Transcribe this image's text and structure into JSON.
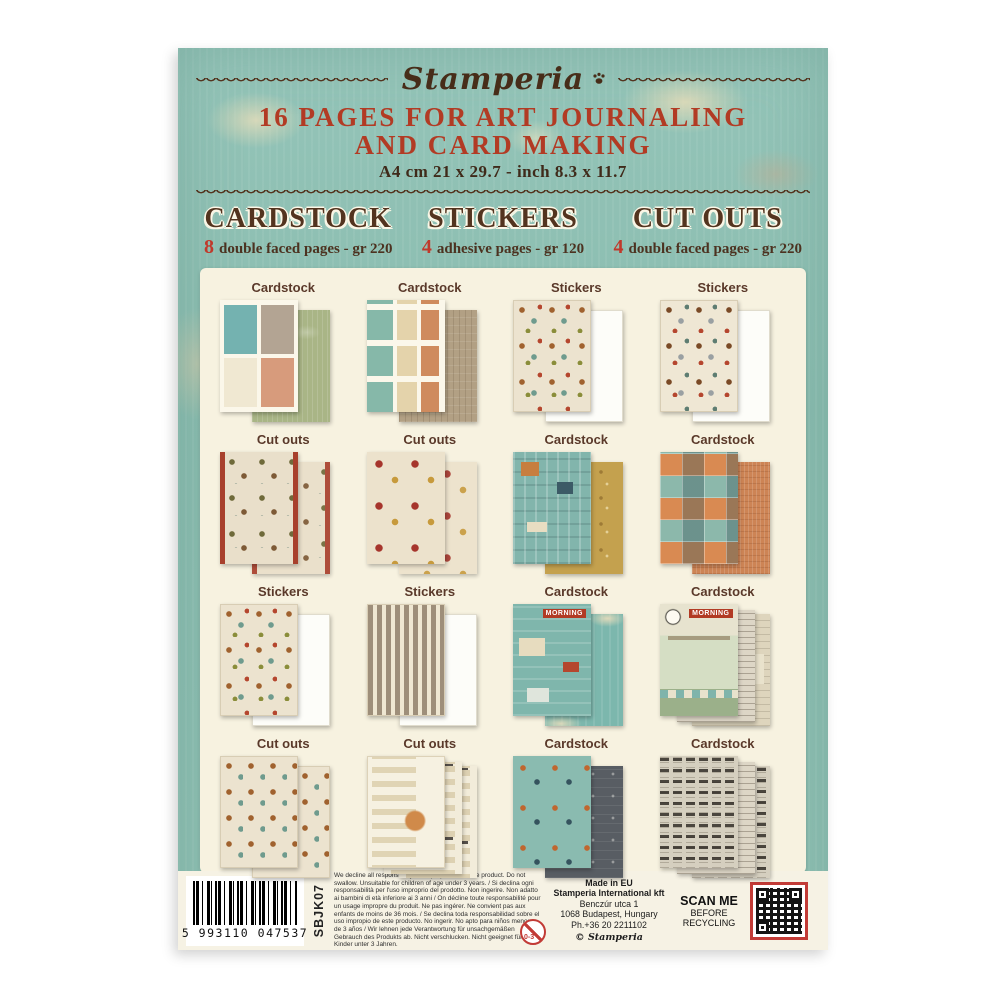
{
  "header": {
    "brand": "Stamperia",
    "title_line1": "16 PAGES FOR ART JOURNALING",
    "title_line2": "AND CARD MAKING",
    "size_line": "A4 cm 21 x 29.7 - inch 8.3 x 11.7"
  },
  "columns": [
    {
      "heading": "CARDSTOCK",
      "count": "8",
      "description": "double faced pages - gr 220"
    },
    {
      "heading": "STICKERS",
      "count": "4",
      "description": "adhesive pages - gr 120"
    },
    {
      "heading": "CUT OUTS",
      "count": "4",
      "description": "double faced pages - gr 220"
    }
  ],
  "grid": {
    "cells": [
      {
        "label": "Cardstock",
        "art": "journal-cards",
        "back": "sage"
      },
      {
        "label": "Cardstock",
        "art": "tags-grid",
        "back": "tan"
      },
      {
        "label": "Stickers",
        "art": "cat-stickers",
        "back": "white"
      },
      {
        "label": "Stickers",
        "art": "dog-stickers",
        "back": "white"
      },
      {
        "label": "Cut outs",
        "art": "animal-cutouts",
        "back": "animal-cutouts-b"
      },
      {
        "label": "Cut outs",
        "art": "flower-cutouts",
        "back": "flower-cutouts-b"
      },
      {
        "label": "Cardstock",
        "art": "letters-teal",
        "back": "mustard"
      },
      {
        "label": "Cardstock",
        "art": "patchwork",
        "back": "orange"
      },
      {
        "label": "Stickers",
        "art": "house-stickers",
        "back": "white"
      },
      {
        "label": "Stickers",
        "art": "alphabet-stickers",
        "back": "white"
      },
      {
        "label": "Cardstock",
        "art": "morning-collage",
        "back": "teal-distress",
        "art_text": "MORNING"
      },
      {
        "label": "Cardstock",
        "art": "kitchen-scene",
        "mid": "newsprint",
        "back": "collage",
        "art_text": "MORNING"
      },
      {
        "label": "Cut outs",
        "art": "numbers-houses",
        "back": "numbers-houses"
      },
      {
        "label": "Cut outs",
        "art": "cat-labels",
        "mid": "labels-strip",
        "back": "labels-strip"
      },
      {
        "label": "Cardstock",
        "art": "typography-teal",
        "back": "charcoal"
      },
      {
        "label": "Cardstock",
        "art": "crossword",
        "mid": "newsprint",
        "back": "crossword"
      }
    ]
  },
  "footer": {
    "website": "www.stamperia.com",
    "barcode_digits": "5 993110 047537",
    "product_code": "SBJK07",
    "disclaimer": "We decline all responsibility for improper use of the product. Do not swallow. Unsuitable for children of age under 3 years. / Si declina ogni responsabilità per l'uso improprio del prodotto. Non ingerire. Non adatto ai bambini di età inferiore ai 3 anni / On décline toute responsabilité pour un usage impropre du produit. Ne pas ingérer. Ne convient pas aux enfants de moins de 36 mois. / Se declina toda responsabilidad sobre el uso impropio de este producto. No ingerir. No apto para niños menores de 3 años / Wir lehnen jede Verantwortung für unsachgemäßen Gebrauch des Produkts ab. Nicht verschlucken. Nicht geeignet für Kinder unter 3 Jahren.",
    "age_warning": "0-3",
    "made_in": "Made in EU",
    "company": "Stamperia International kft",
    "address_line1": "Benczúr utca 1",
    "address_line2": "1068 Budapest, Hungary",
    "phone": "Ph.+36 20 2211102",
    "copyright_symbol": "©",
    "copyright": "Stamperia",
    "scan_line1": "SCAN ME",
    "scan_line2": "BEFORE",
    "scan_line3": "RECYCLING"
  },
  "colors": {
    "background_teal": "#8dbfb2",
    "accent_red": "#b23b24",
    "text_brown": "#4c3220",
    "panel_cream": "#f7f2e0",
    "qr_border_red": "#c23b36"
  }
}
